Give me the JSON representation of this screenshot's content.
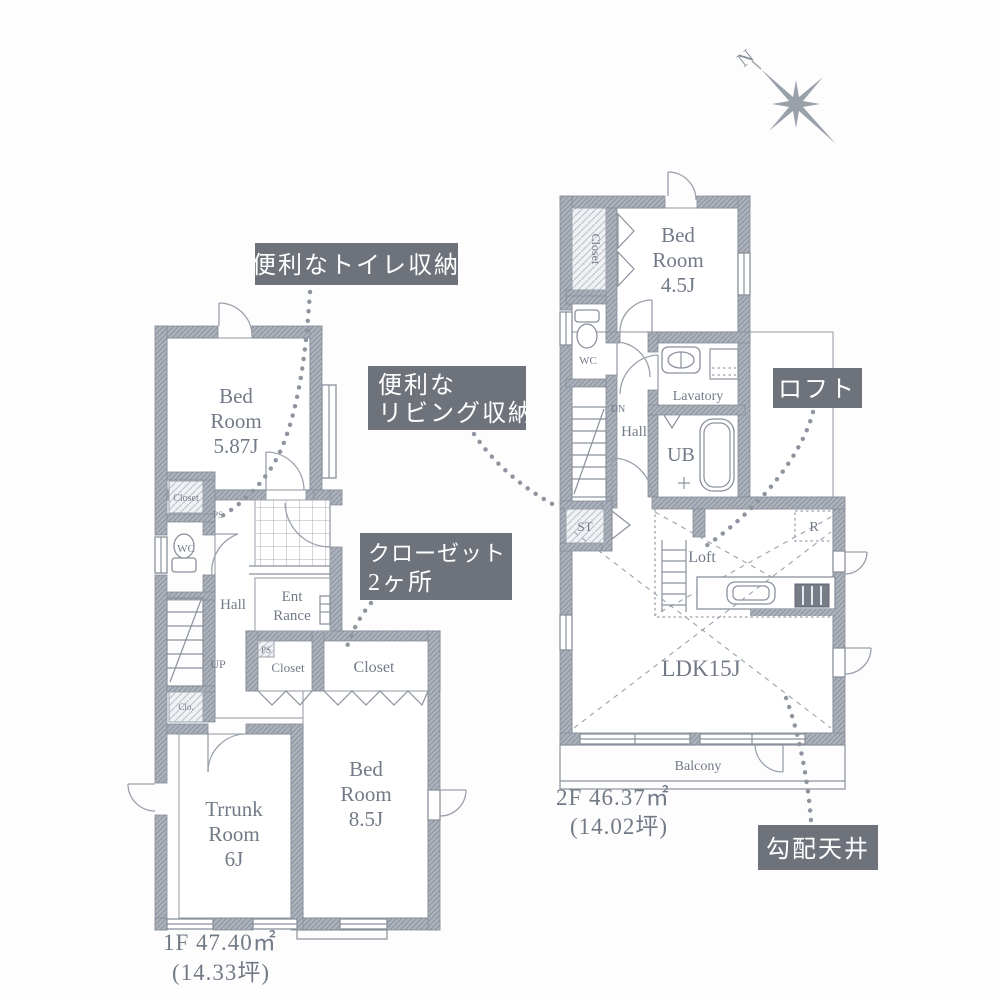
{
  "colors": {
    "wall": "#adb3bc",
    "callout_bg": "#6e737b",
    "callout_text": "#ffffff",
    "ink": "#8a919c",
    "text": "#727a88"
  },
  "compass": {
    "n": "N"
  },
  "floor1": {
    "bedroom1": [
      "Bed",
      "Room",
      "5.87J"
    ],
    "closet_top": "Closet",
    "ps_top": "PS",
    "wc": "WC",
    "hall": "Hall",
    "up": "UP",
    "entrance": [
      "Ent",
      "Rance"
    ],
    "ps_mid": "PS",
    "closet_a": "Closet",
    "closet_b": "Closet",
    "closet_small": "Clo.",
    "trunk": [
      "Trrunk",
      "Room",
      "6J"
    ],
    "bedroom2": [
      "Bed",
      "Room",
      "8.5J"
    ],
    "area": [
      "1F 47.40㎡",
      "(14.33坪)"
    ]
  },
  "floor2": {
    "closet": "Closet",
    "bedroom": [
      "Bed",
      "Room",
      "4.5J"
    ],
    "wc": "WC",
    "dn": "DN",
    "hall": "Hall",
    "lavatory": "Lavatory",
    "ub": "UB",
    "st": "ST",
    "loft": "Loft",
    "fridge": "R",
    "ldk": "LDK15J",
    "balcony": "Balcony",
    "area": [
      "2F 46.37㎡",
      "(14.02坪)"
    ]
  },
  "callouts": {
    "toilet_storage": "便利なトイレ収納",
    "living_storage": [
      "便利な",
      "リビング収納"
    ],
    "closets": [
      "クローゼット",
      "2ヶ所"
    ],
    "loft": "ロフト",
    "sloped_ceiling": "勾配天井"
  }
}
